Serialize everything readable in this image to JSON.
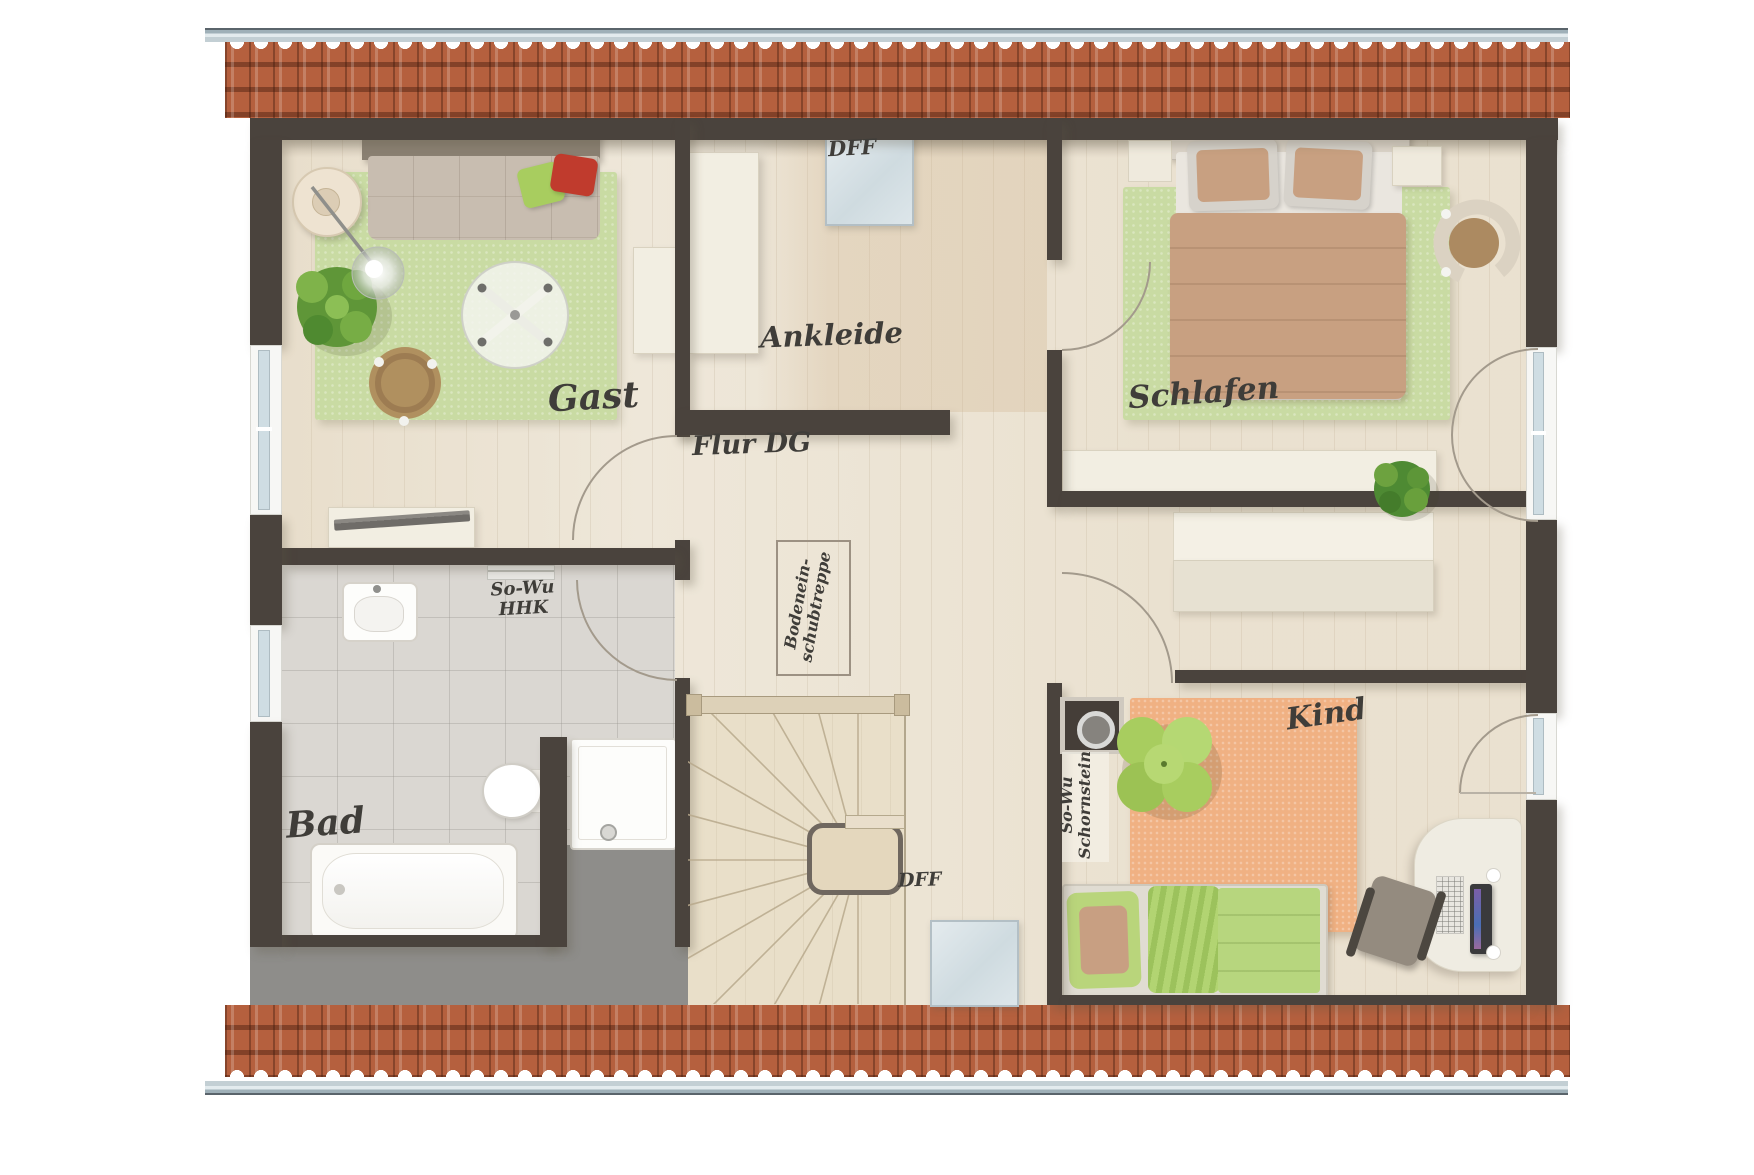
{
  "rooms": {
    "gast": {
      "label": "Gast"
    },
    "ankleide": {
      "label": "Ankleide"
    },
    "schlafen": {
      "label": "Schlafen"
    },
    "flur": {
      "label": "Flur DG"
    },
    "bad": {
      "label": "Bad"
    },
    "kind": {
      "label": "Kind"
    }
  },
  "annotations": {
    "dff_top": "DFF",
    "dff_bottom": "DFF",
    "sowu_hhk": {
      "line1": "So-Wu",
      "line2": "HHK"
    },
    "sowu_schornstein": {
      "line1": "So-Wu",
      "line2": "Schornstein"
    },
    "bodeneinschubtreppe": {
      "line1": "Bodenein-",
      "line2": "schubtreppe"
    }
  },
  "colors": {
    "wall": "#4a433d",
    "roof_tile": "#b5603e",
    "roof_tile_dark": "#8f4a30",
    "gutter_light": "#c3cfd4",
    "gutter_dark": "#5a646b",
    "floor_wood": "#eee7d9",
    "floor_tile": "#dad7d2",
    "attic_gray": "#8e8d8a",
    "stair_wood": "#e9dfc9",
    "rug_green": "#c9dba3",
    "rug_orange": "#f0b183",
    "accent_green": "#a8cd5f",
    "accent_red": "#c03b2d",
    "bed_tan": "#c8a081",
    "cream": "#f2eee2",
    "glass": "#cfdde3",
    "white_frame": "#f7f7f5",
    "ink": "#3f3d39"
  }
}
